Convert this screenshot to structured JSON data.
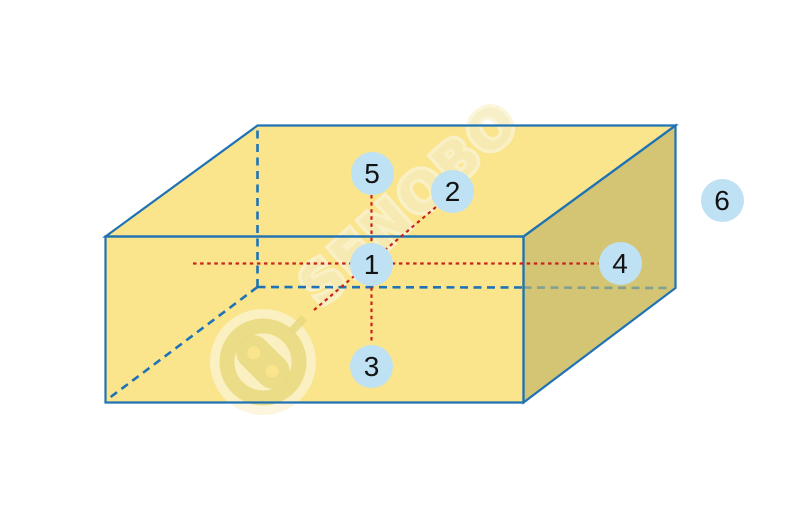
{
  "diagram": {
    "watermark_text": "SENOBO"
  },
  "markers": [
    {
      "label": "1"
    },
    {
      "label": "2"
    },
    {
      "label": "3"
    },
    {
      "label": "4"
    },
    {
      "label": "5"
    },
    {
      "label": "6"
    }
  ],
  "colors": {
    "background": "#ffffff",
    "face_light": "#FAE58C",
    "face_dark": "#D3C574",
    "edge_blue": "#1F73B4",
    "axis_red": "#C9241C",
    "marker_fill": "#BEE1F4",
    "marker_text": "#131313",
    "watermark_ink": "#E9DA82",
    "watermark_halo": "#FBF3D3",
    "watermark_text_color": "#F6ECBB"
  }
}
